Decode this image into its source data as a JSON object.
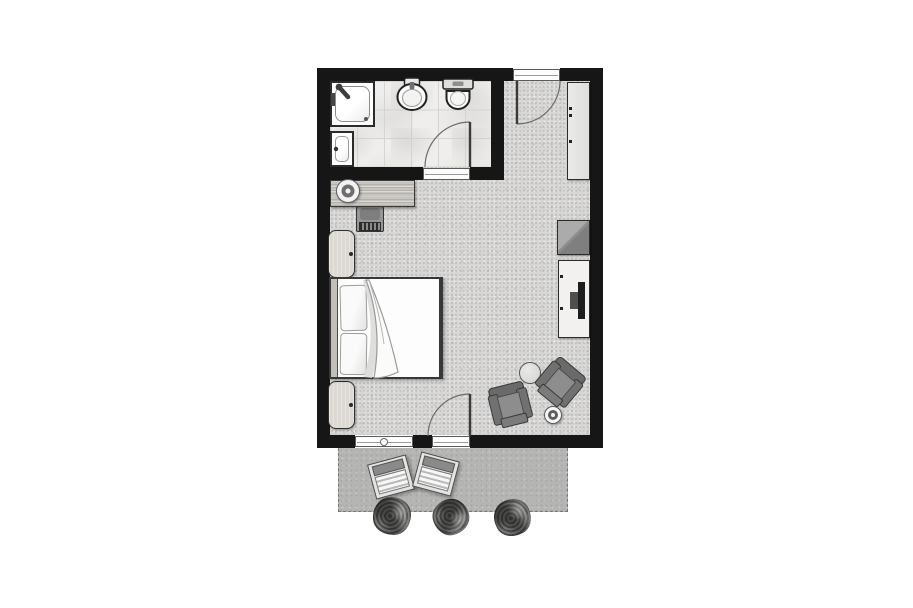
{
  "meta": {
    "type": "architectural floor plan",
    "subject": "hotel guest room with en-suite bathroom and terrace",
    "text_visible_in_image": "none"
  },
  "canvas": {
    "width": 913,
    "height": 608,
    "background": "#ffffff"
  },
  "palette": {
    "wall": "#161616",
    "carpet": "#d7d6d5",
    "bathroom_tile": "#efeeec",
    "terrace": "#b5b5b4",
    "furniture_dark": "#6a6a6a",
    "furniture_light": "#f2f1ef",
    "wood": "#c8c5c0",
    "bed_linen": "#fdfdfd"
  },
  "labels": {
    "plan": "Hotel room floor plan",
    "bathroom": "Bathroom",
    "bedroom": "Bedroom / living area",
    "entry": "Entry",
    "terrace": "Terrace",
    "shower": "Shower enclosure",
    "vanity": "Vanity basin",
    "washbasin": "Washbasin",
    "toilet": "Toilet",
    "bathroom_door": "Bathroom door (swings into bathroom)",
    "entrance_door": "Entrance door (swings into entry)",
    "terrace_door": "Terrace door (swings into room)",
    "window": "Window",
    "wardrobe": "Wardrobe",
    "desk": "Desk",
    "desk_lamp": "Desk lamp",
    "desk_chair": "Desk chair",
    "nightstand_top": "Nightstand",
    "nightstand_bottom": "Nightstand",
    "bed": "Double bed",
    "headboard": "Headboard",
    "pillow": "Pillow",
    "duvet": "Duvet with folded corner",
    "minibar": "Minibar cabinet",
    "tv_console": "TV sideboard",
    "tv": "Television",
    "side_table": "Round side table",
    "armchair_left": "Armchair",
    "armchair_right": "Armchair",
    "floor_lamp": "Floor lamp",
    "lounger_1": "Sun lounger",
    "lounger_2": "Sun lounger",
    "bush_1": "Shrub",
    "bush_2": "Shrub",
    "bush_3": "Shrub"
  }
}
